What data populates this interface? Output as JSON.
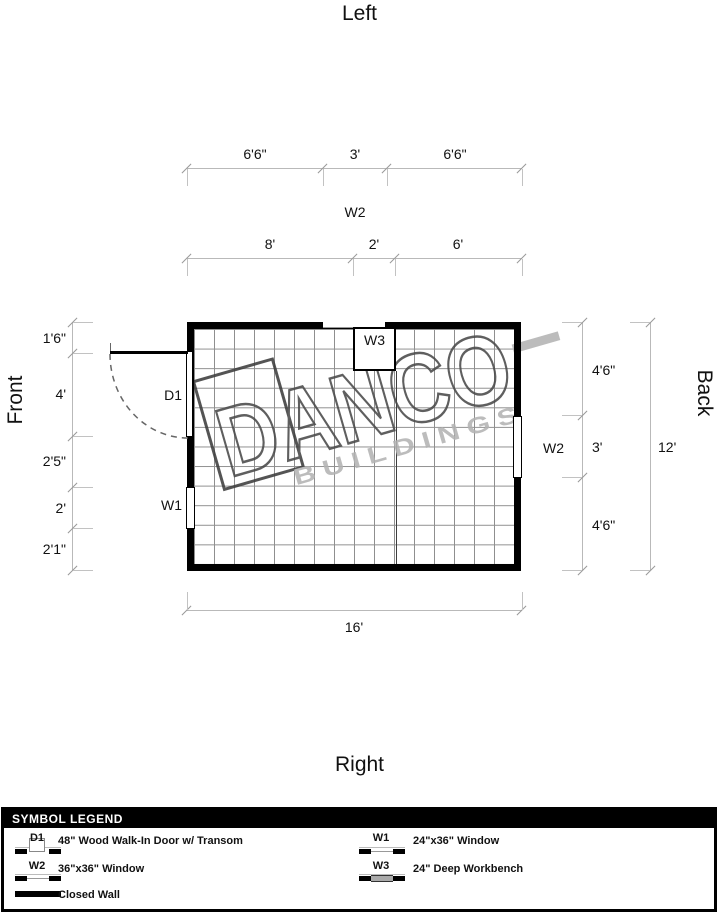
{
  "orientation": {
    "top": "Left",
    "bottom": "Right",
    "left": "Front",
    "right": "Back"
  },
  "dims": {
    "t1": [
      "6'6\"",
      "3'",
      "6'6\""
    ],
    "t1_feature": "W2",
    "t2": [
      "8'",
      "2'",
      "6'"
    ],
    "left": [
      "1'6\"",
      "4'",
      "2'5\"",
      "2'",
      "2'1\""
    ],
    "right": [
      "4'6\"",
      "3'",
      "4'6\""
    ],
    "right_total": "12'",
    "bottom_total": "16'"
  },
  "plan": {
    "door": "D1",
    "w1": "W1",
    "w2": "W2",
    "w3": "W3"
  },
  "watermark": {
    "name": "DANCO",
    "sub": "BUILDINGS"
  },
  "legend": {
    "title": "SYMBOL LEGEND",
    "entries": [
      {
        "code": "D1",
        "desc": "48\" Wood Walk-In Door w/ Transom"
      },
      {
        "code": "W1",
        "desc": "24\"x36\" Window"
      },
      {
        "code": "W2",
        "desc": "36\"x36\" Window"
      },
      {
        "code": "W3",
        "desc": "24\" Deep Workbench"
      },
      {
        "code": "",
        "desc": "Closed Wall"
      }
    ]
  },
  "colors": {
    "wall": "#000000",
    "grid": "#8f8f8f",
    "dim_line": "#b9b9b9",
    "watermark_grey": "#b3b3b3"
  }
}
